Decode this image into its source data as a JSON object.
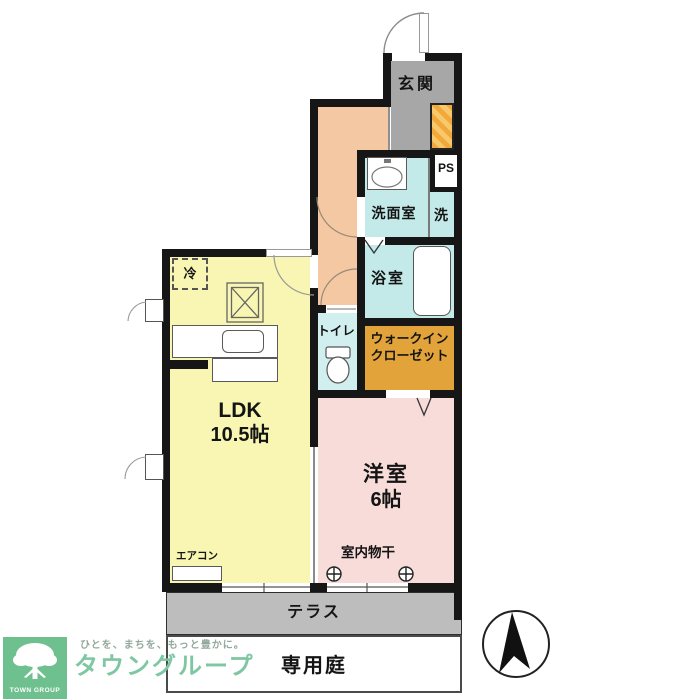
{
  "plan": {
    "rooms": {
      "genkan": {
        "label": "玄関"
      },
      "washroom": {
        "label": "洗面室"
      },
      "washer": {
        "label": "洗"
      },
      "pipe_space": {
        "label": "PS"
      },
      "bath": {
        "label": "浴室"
      },
      "toilet": {
        "label": "トイレ"
      },
      "walk_in_closet": {
        "line1": "ウォークイン",
        "line2": "クローゼット"
      },
      "ldk": {
        "label": "LDK",
        "size": "10.5帖"
      },
      "bedroom": {
        "label": "洋室",
        "size": "6帖"
      },
      "terrace": {
        "label": "テラス"
      },
      "garden": {
        "label": "専用庭"
      }
    },
    "fixtures": {
      "fridge": "冷",
      "aircon": "エアコン",
      "indoor_drying": "室内物干"
    },
    "icons": {
      "compass": "north-arrow",
      "drying_hook": "circle-cross",
      "entrance_storage": "shoe-cabinet-hatched",
      "stove": "two-burner-stove",
      "toilet_bowl": "toilet",
      "sink": "vanity-basin",
      "bathtub": "bathtub"
    },
    "colors": {
      "wall": "#161616",
      "ldk": "#f8f6b2",
      "bedroom": "#f8dcda",
      "hallway": "#f3c8a2",
      "wet_rooms": "#c3eae9",
      "toilet": "#d2efef",
      "closet": "#e2a33b",
      "genkan": "#a7a7a7",
      "terrace": "#bdbdbd",
      "shoe_cabinet": "#f2a93b",
      "logo_green": "#6fc08f",
      "brand_green": "#7fc7a2"
    }
  },
  "footer": {
    "logo_square": "TOWN GROUP",
    "tagline": "ひとを、まちを、もっと豊かに。",
    "brand": "タウングループ"
  }
}
